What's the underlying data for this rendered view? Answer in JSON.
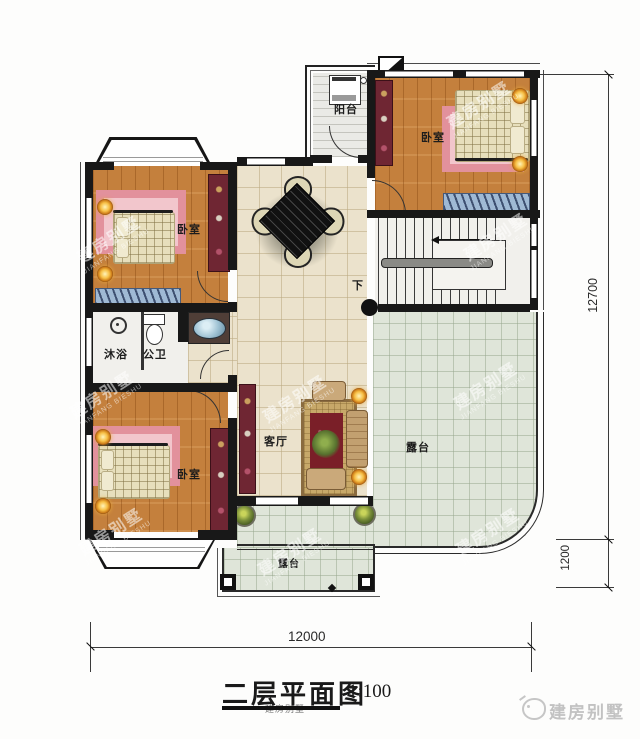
{
  "plan": {
    "labels": {
      "balcony": "阳台",
      "bedroom": "卧室",
      "shower": "沐浴",
      "toilet": "公卫",
      "living": "客厅",
      "terrace": "露台",
      "down": "下"
    },
    "dimensions": {
      "total_height": "12700",
      "terrace_depth": "1200",
      "total_width": "12000"
    }
  },
  "title": {
    "text": "二层平面图",
    "scale": "1:100"
  },
  "footer_logo": {
    "text": "建房别墅"
  },
  "watermark": {
    "line1": "建房别墅",
    "line2": "JIANFANG BIESHU"
  },
  "colors": {
    "wall": "#181818",
    "wood_floor": "#c4803d",
    "hall_tile": "#ebe2cc",
    "terrace_tile": "#dfe5d9",
    "carpet_pink": "#e2919c",
    "wardrobe_maroon": "#6f2633",
    "lamp_glow": "#f7bf45",
    "bench_blue": "#9fb9d4"
  }
}
